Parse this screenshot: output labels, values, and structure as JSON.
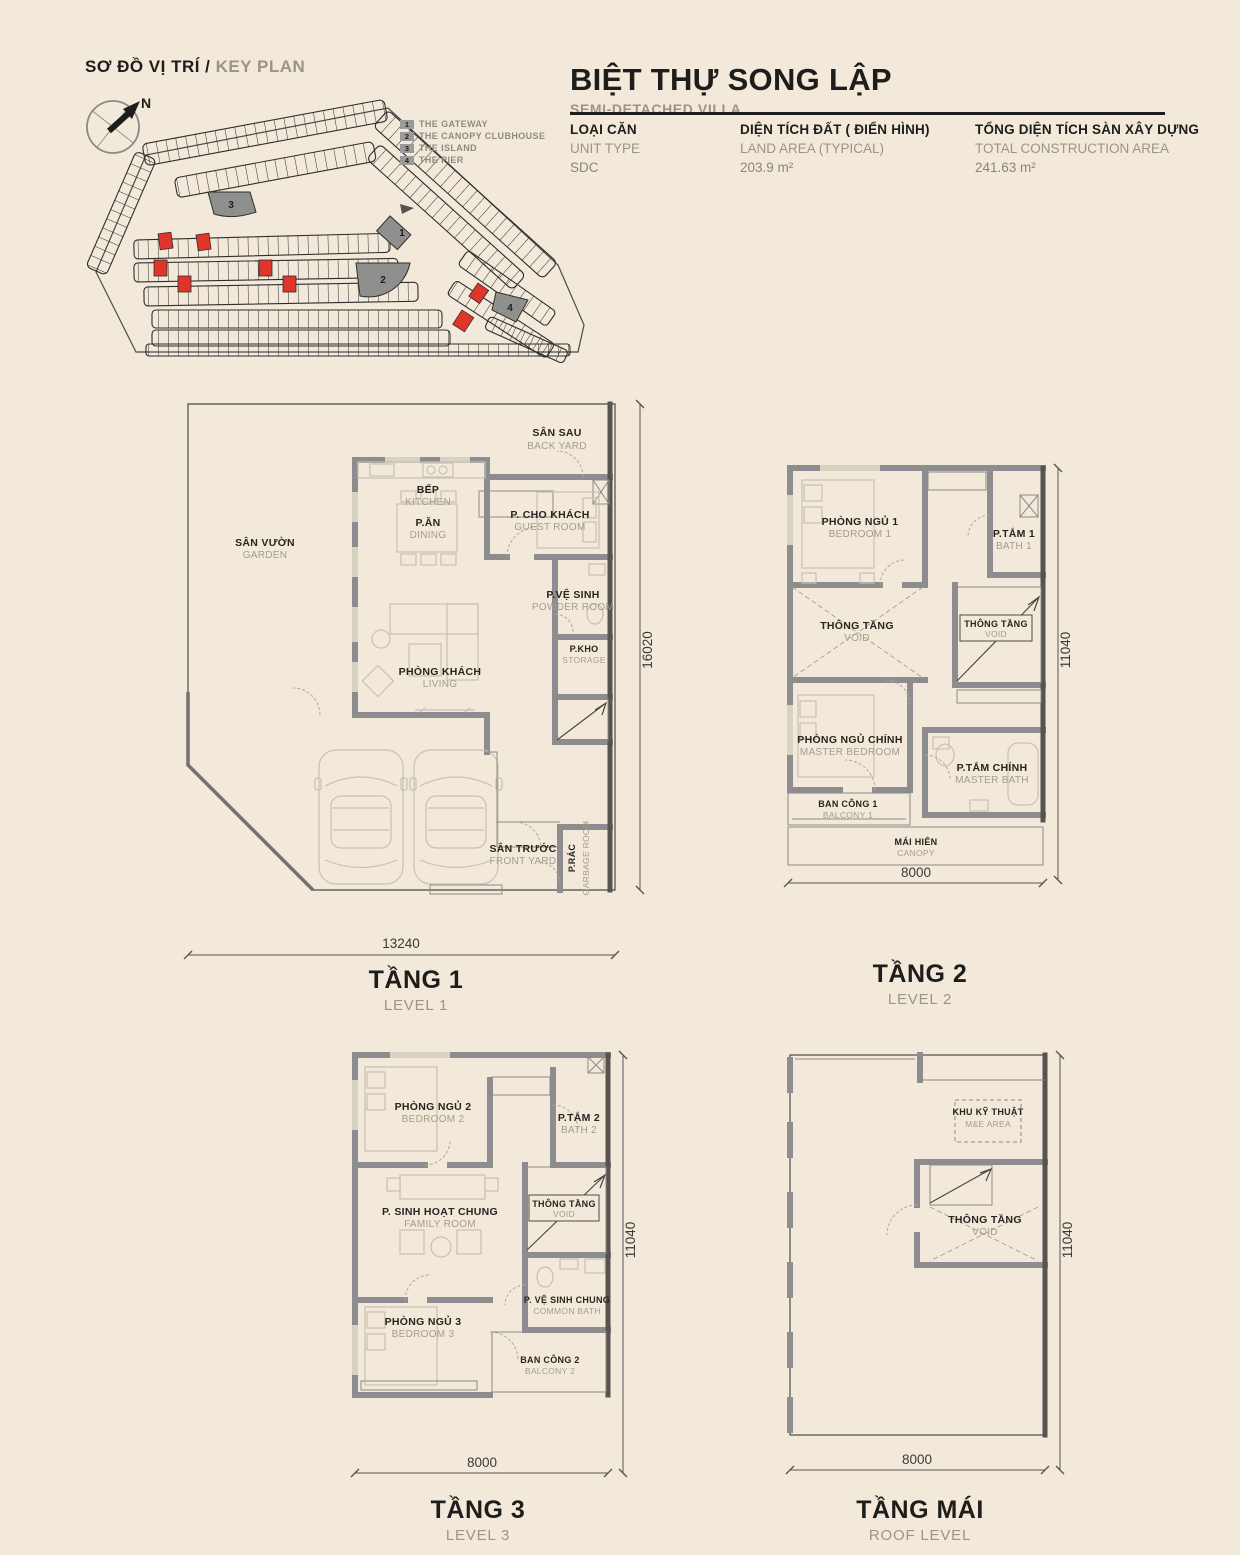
{
  "page_bg": "#f2e9da",
  "accent_red": "#e0352b",
  "wall_gray": "#8d8d8f",
  "key_plan": {
    "title_vi": "SƠ ĐỒ VỊ TRÍ /",
    "title_en": "KEY PLAN",
    "north": "N",
    "legend": [
      {
        "num": "1",
        "label": "THE GATEWAY"
      },
      {
        "num": "2",
        "label": "THE CANOPY CLUBHOUSE"
      },
      {
        "num": "3",
        "label": "THE ISLAND"
      },
      {
        "num": "4",
        "label": "THE PIER"
      }
    ]
  },
  "header": {
    "title": "BIỆT THỰ SONG LẬP",
    "subtitle": "SEMI-DETACHED VILLA",
    "specs": [
      {
        "vi": "LOẠI CĂN",
        "en": "UNIT TYPE",
        "value": "SDC"
      },
      {
        "vi": "DIỆN TÍCH ĐẤT ( ĐIỂN HÌNH)",
        "en": "LAND AREA (TYPICAL)",
        "value": "203.9 m²"
      },
      {
        "vi": "TỔNG DIỆN TÍCH SÀN XÂY DỰNG",
        "en": "TOTAL CONSTRUCTION AREA",
        "value": "241.63 m²"
      }
    ]
  },
  "levels": [
    {
      "title_vi": "TẦNG 1",
      "title_en": "LEVEL 1",
      "dim_bottom": "13240",
      "dim_side": "16020",
      "rooms": {
        "backyard": {
          "vi": "SÂN SAU",
          "en": "BACK YARD"
        },
        "kitchen": {
          "vi": "BẾP",
          "en": "KITCHEN"
        },
        "dining": {
          "vi": "P.ĂN",
          "en": "DINING"
        },
        "guest": {
          "vi": "P. CHO KHÁCH",
          "en": "GUEST ROOM"
        },
        "powder": {
          "vi": "P.VỆ SINH",
          "en": "POWDER ROOM"
        },
        "storage": {
          "vi": "P.KHO",
          "en": "STORAGE"
        },
        "garden": {
          "vi": "SÂN VƯỜN",
          "en": "GARDEN"
        },
        "living": {
          "vi": "PHÒNG KHÁCH",
          "en": "LIVING"
        },
        "frontyard": {
          "vi": "SÂN TRƯỚC",
          "en": "FRONT YARD"
        },
        "garbage": {
          "vi": "P.RÁC",
          "en": "GARBAGE ROOM"
        }
      }
    },
    {
      "title_vi": "TẦNG 2",
      "title_en": "LEVEL 2",
      "dim_bottom": "8000",
      "dim_side": "11040",
      "rooms": {
        "bedroom1": {
          "vi": "PHÒNG NGỦ 1",
          "en": "BEDROOM 1"
        },
        "bath1": {
          "vi": "P.TẮM 1",
          "en": "BATH 1"
        },
        "void": {
          "vi": "THÔNG TẦNG",
          "en": "VOID"
        },
        "stair_void": {
          "vi": "THÔNG TẦNG",
          "en": "VOID"
        },
        "master": {
          "vi": "PHÒNG NGỦ CHÍNH",
          "en": "MASTER BEDROOM"
        },
        "masterbath": {
          "vi": "P.TẮM CHÍNH",
          "en": "MASTER BATH"
        },
        "balcony1": {
          "vi": "BAN CÔNG 1",
          "en": "BALCONY 1"
        },
        "canopy": {
          "vi": "MÁI HIÊN",
          "en": "CANOPY"
        }
      }
    },
    {
      "title_vi": "TẦNG 3",
      "title_en": "LEVEL 3",
      "dim_bottom": "8000",
      "dim_side": "11040",
      "rooms": {
        "bedroom2": {
          "vi": "PHÒNG NGỦ 2",
          "en": "BEDROOM 2"
        },
        "bath2": {
          "vi": "P.TẮM 2",
          "en": "BATH 2"
        },
        "family": {
          "vi": "P. SINH HOẠT CHUNG",
          "en": "FAMILY ROOM"
        },
        "stair_void": {
          "vi": "THÔNG TẦNG",
          "en": "VOID"
        },
        "bedroom3": {
          "vi": "PHÒNG NGỦ 3",
          "en": "BEDROOM 3"
        },
        "commonbath": {
          "vi": "P. VỆ SINH CHUNG",
          "en": "COMMON BATH"
        },
        "balcony2": {
          "vi": "BAN CÔNG 2",
          "en": "BALCONY 2"
        }
      }
    },
    {
      "title_vi": "TẦNG MÁI",
      "title_en": "ROOF LEVEL",
      "dim_bottom": "8000",
      "dim_side": "11040",
      "rooms": {
        "mne": {
          "vi": "KHU KỸ THUẬT",
          "en": "M&E AREA"
        },
        "void": {
          "vi": "THÔNG TẦNG",
          "en": "VOID"
        }
      }
    }
  ]
}
